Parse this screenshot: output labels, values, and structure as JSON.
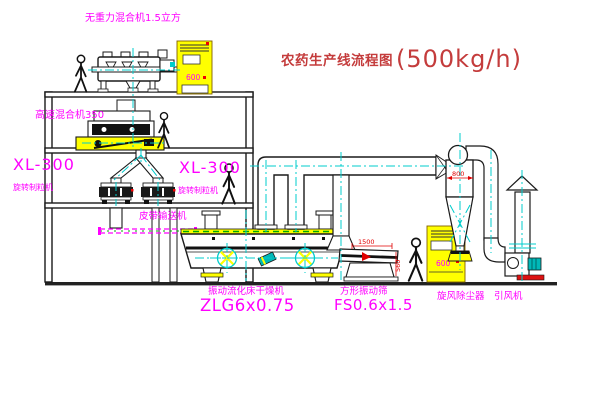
{
  "title": {
    "text": "农药生产线流程图",
    "capacity": "(500kg/h)"
  },
  "labels": {
    "gravity_mixer": "无重力混合机1.5立方",
    "high_speed_mixer": "高速混合机350",
    "granulator_left_model": "XL-300",
    "granulator_left_name": "旋转制粒机",
    "granulator_right_model": "XL-300",
    "granulator_right_name": "旋转制粒机",
    "belt_conveyor": "皮带输送机",
    "dryer_name": "振动流化床干燥机",
    "dryer_model": "ZLG6x0.75",
    "screen_name": "方形振动筛",
    "screen_model": "FS0.6x1.5",
    "cyclone_name": "旋风除尘器",
    "fan_name": "引风机"
  },
  "dimensions": {
    "cyclone_diameter": "800",
    "screen_length": "1500",
    "screen_height": "560"
  },
  "cabinets": {
    "top_panel_text": "600",
    "right_panel_text": "600"
  },
  "colors": {
    "label_magenta": "#FF00FF",
    "title_red": "#C43C3C",
    "dimension_red": "#E00000",
    "centerline_cyan": "#00CCCC",
    "machine_yellow": "#FFFF00",
    "conveyor_green": "#00AA00",
    "line_black": "#1a1a1a",
    "motor_teal": "#00B8B8"
  }
}
